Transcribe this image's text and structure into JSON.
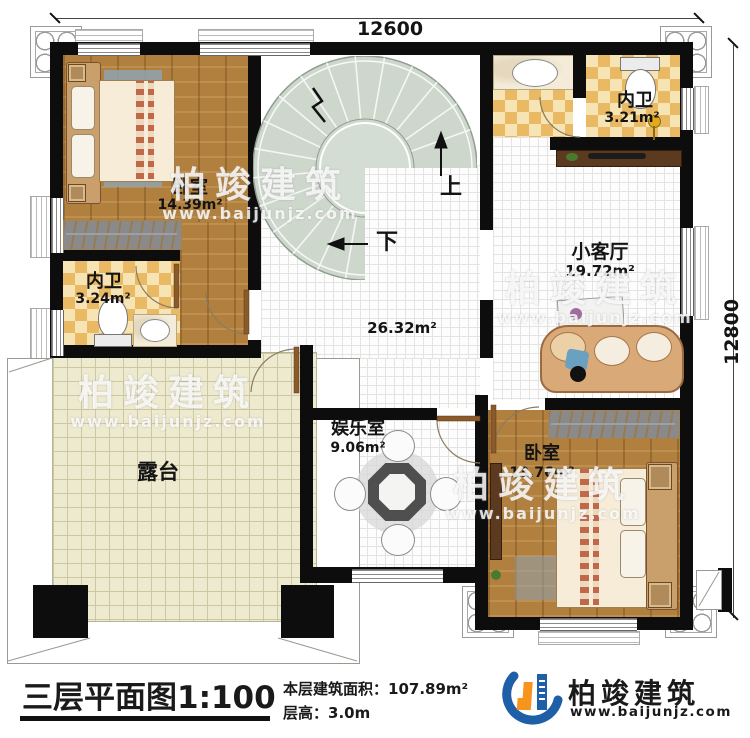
{
  "dimensions": {
    "width": "12600",
    "height": "12800"
  },
  "stair": {
    "up": "上",
    "down": "下"
  },
  "rooms": {
    "bedroom_tl": {
      "name": "卧室",
      "area": "14.39m²"
    },
    "bath_tr": {
      "name": "内卫",
      "area": "3.21m²"
    },
    "bath_l": {
      "name": "内卫",
      "area": "3.24m²"
    },
    "hall": {
      "area": "26.32m²"
    },
    "living": {
      "name": "小客厅",
      "area": "19.72m²"
    },
    "game": {
      "name": "娱乐室",
      "area": "9.06m²"
    },
    "bedroom_br": {
      "name": "卧室",
      "area": "13.76m²"
    },
    "terrace": {
      "name": "露台"
    }
  },
  "watermark": {
    "brand": "柏竣建筑",
    "url": "www.baijunjz.com"
  },
  "footer": {
    "title": "三层平面图",
    "scale": "1:100",
    "area_label": "本层建筑面积：",
    "area_value": "107.89m²",
    "floor_height_label": "层高：",
    "floor_height_value": "3.0m",
    "brand": "柏竣建筑",
    "brand_url": "www.baijunjz.com"
  },
  "colors": {
    "wall": "#0d0d0d",
    "wood": "#b2803e",
    "checker": "#e9b963",
    "stair": "#cdd7cc",
    "terrace": "#eeeacf",
    "brand_blue": "#1e5fa8",
    "brand_orange": "#f7941d"
  }
}
